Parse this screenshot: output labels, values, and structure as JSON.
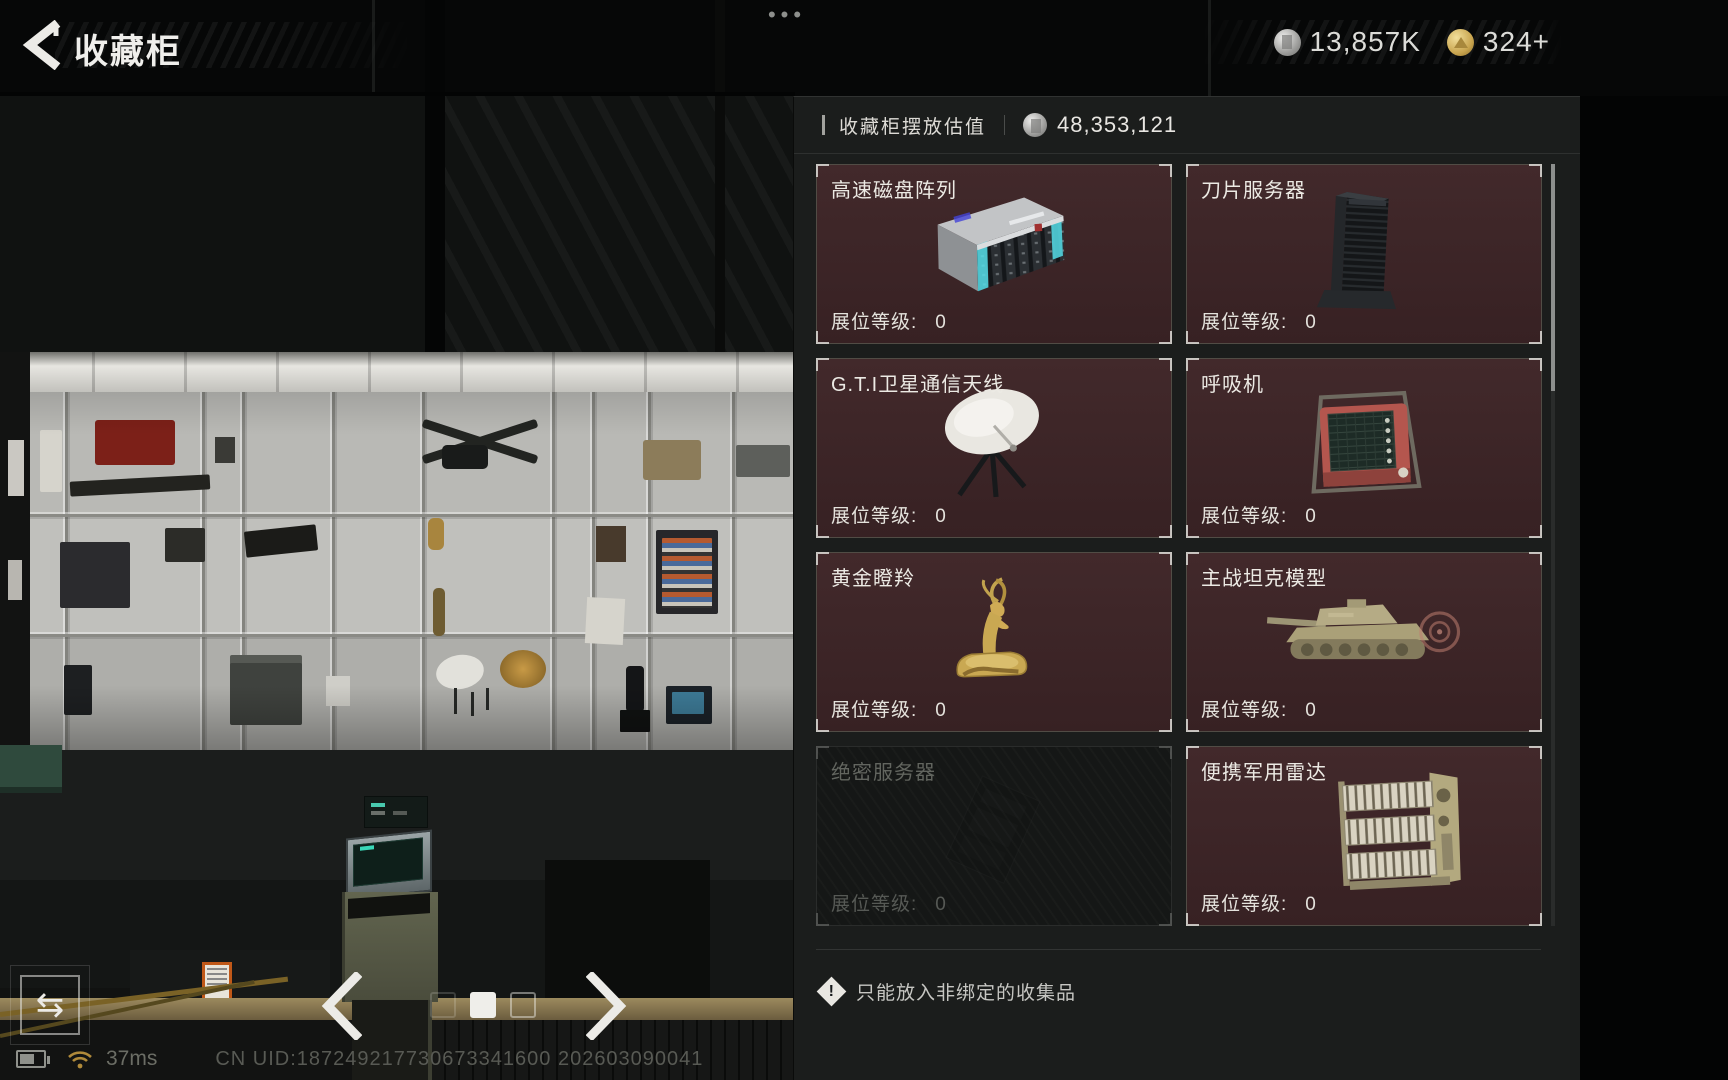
{
  "top_bar": {
    "title": "收藏柜",
    "menu_dots": "•••",
    "currencies": [
      {
        "icon": "silver-coin",
        "value": "13,857K"
      },
      {
        "icon": "gold-coin",
        "value": "324+"
      }
    ]
  },
  "panel": {
    "header_label": "收藏柜摆放估值",
    "header_value": "48,353,121",
    "level_label": "展位等级:",
    "items": [
      {
        "name": "高速磁盘阵列",
        "level": "0",
        "icon": "disk-array",
        "disabled": false
      },
      {
        "name": "刀片服务器",
        "level": "0",
        "icon": "blade-server",
        "disabled": false
      },
      {
        "name": "G.T.I卫星通信天线",
        "level": "0",
        "icon": "satellite-antenna",
        "disabled": false
      },
      {
        "name": "呼吸机",
        "level": "0",
        "icon": "ventilator",
        "disabled": false
      },
      {
        "name": "黄金瞪羚",
        "level": "0",
        "icon": "golden-gazelle",
        "disabled": false
      },
      {
        "name": "主战坦克模型",
        "level": "0",
        "icon": "tank-model",
        "disabled": false
      },
      {
        "name": "绝密服务器",
        "level": "0",
        "icon": "secret-server",
        "disabled": true
      },
      {
        "name": "便携军用雷达",
        "level": "0",
        "icon": "military-radar",
        "disabled": false
      }
    ],
    "warning": "只能放入非绑定的收集品"
  },
  "pager": {
    "total": 3,
    "active_index": 1
  },
  "bottom_left": {
    "swap_glyph": "⇆"
  },
  "status_bar": {
    "ping": "37ms",
    "uid": "CN UID:187249217730673341600 202603090041"
  },
  "colors": {
    "card_bg": "#3e2528",
    "panel_bg": "#1b1d1c",
    "accent_teal": "#39d8b8",
    "gold": "#c8a44e"
  }
}
